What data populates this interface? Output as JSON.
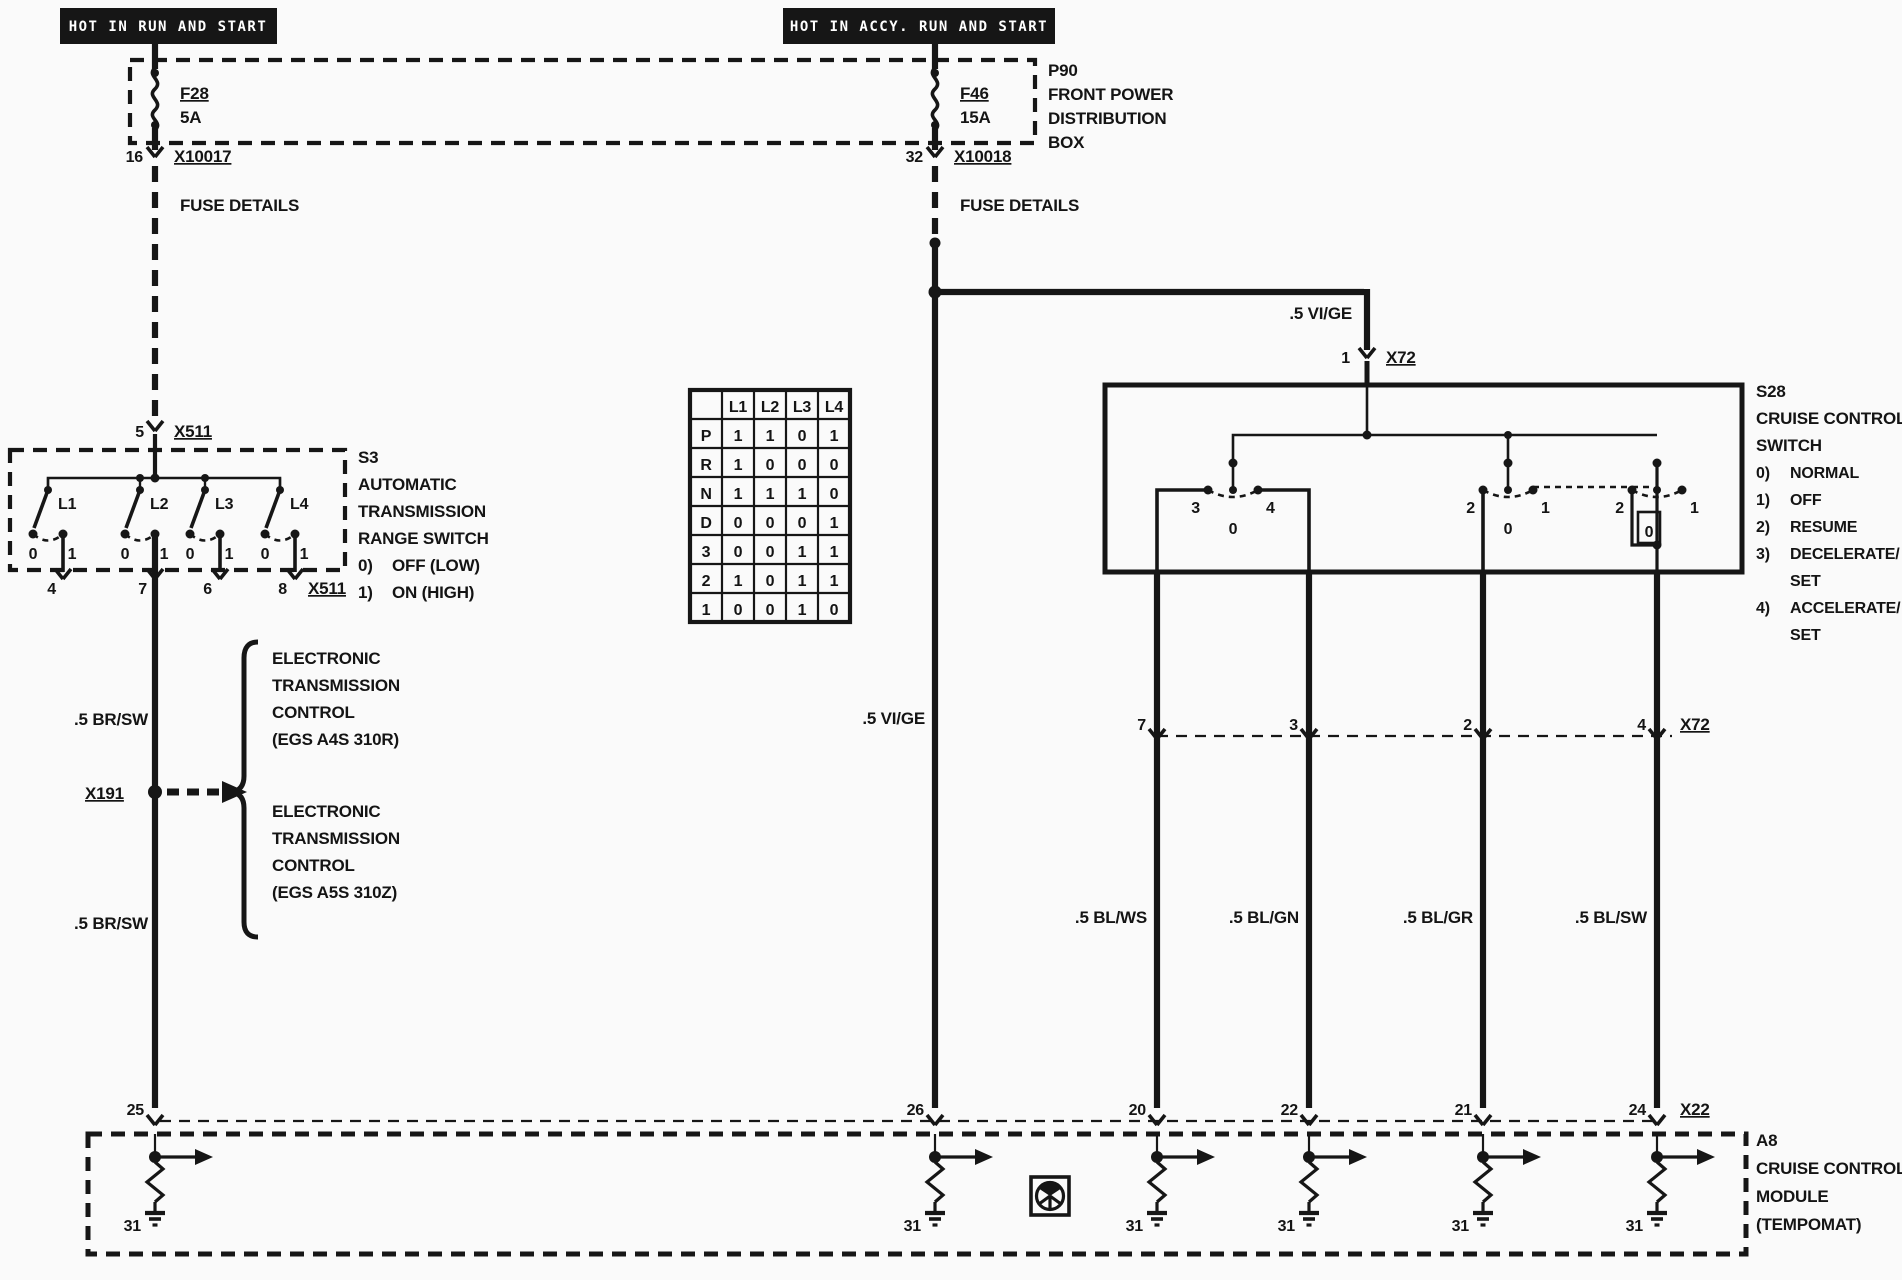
{
  "banners": {
    "left": "HOT IN RUN AND START",
    "right": "HOT IN ACCY. RUN AND START"
  },
  "p90": {
    "id": "P90",
    "name1": "FRONT POWER",
    "name2": "DISTRIBUTION",
    "name3": "BOX"
  },
  "f28": {
    "id": "F28",
    "rating": "5A",
    "pin": "16",
    "connector": "X10017",
    "note": "FUSE DETAILS"
  },
  "f46": {
    "id": "F46",
    "rating": "15A",
    "pin": "32",
    "connector": "X10018",
    "note": "FUSE DETAILS"
  },
  "s3": {
    "id": "S3",
    "name1": "AUTOMATIC",
    "name2": "TRANSMISSION",
    "name3": "RANGE SWITCH",
    "pos0key": "0)",
    "pos0": "OFF (LOW)",
    "pos1key": "1)",
    "pos1": "ON (HIGH)",
    "pin_top": "5",
    "connector_top": "X511",
    "gates": [
      "L1",
      "L2",
      "L3",
      "L4"
    ],
    "off": "0",
    "on": "1",
    "pins": [
      "4",
      "7",
      "6",
      "8"
    ],
    "connector_bottom": "X511"
  },
  "table": {
    "cols": [
      "L1",
      "L2",
      "L3",
      "L4"
    ],
    "rows": [
      [
        "P",
        "1",
        "1",
        "0",
        "1"
      ],
      [
        "R",
        "1",
        "0",
        "0",
        "0"
      ],
      [
        "N",
        "1",
        "1",
        "1",
        "0"
      ],
      [
        "D",
        "0",
        "0",
        "0",
        "1"
      ],
      [
        "3",
        "0",
        "0",
        "1",
        "1"
      ],
      [
        "2",
        "1",
        "0",
        "1",
        "1"
      ],
      [
        "1",
        "0",
        "0",
        "1",
        "0"
      ]
    ]
  },
  "left_wire": {
    "label_upper": ".5 BR/SW",
    "label_lower": ".5 BR/SW",
    "connector": "X191",
    "target1": [
      "ELECTRONIC",
      "TRANSMISSION",
      "CONTROL",
      "(EGS A4S 310R)"
    ],
    "target2": [
      "ELECTRONIC",
      "TRANSMISSION",
      "CONTROL",
      "(EGS A5S 310Z)"
    ]
  },
  "mid_wire": {
    "label": ".5 VI/GE",
    "label2": ".5 VI/GE",
    "pin": "1",
    "connector": "X72"
  },
  "s28": {
    "id": "S28",
    "name1": "CRUISE CONTROL",
    "name2": "SWITCH",
    "legend": [
      [
        "0)",
        "NORMAL"
      ],
      [
        "1)",
        "OFF"
      ],
      [
        "2)",
        "RESUME"
      ],
      [
        "3)",
        "DECELERATE/"
      ],
      [
        "",
        "SET"
      ],
      [
        "4)",
        "ACCELERATE/"
      ],
      [
        "",
        "SET"
      ]
    ],
    "sw1": {
      "l": "3",
      "c": "0",
      "r": "4"
    },
    "sw2": {
      "l": "2",
      "c": "0",
      "r": "1"
    },
    "sw3": {
      "l": "2",
      "c": "0",
      "r": "1"
    }
  },
  "x72_row": {
    "pins": [
      "7",
      "3",
      "2",
      "4"
    ],
    "connector": "X72"
  },
  "wire_labels": [
    ".5 BL/WS",
    ".5 BL/GN",
    ".5 BL/GR",
    ".5 BL/SW"
  ],
  "a8": {
    "id": "A8",
    "name1": "CRUISE CONTROL",
    "name2": "MODULE",
    "name3": "(TEMPOMAT)",
    "connector": "X22",
    "pins": [
      "25",
      "26",
      "20",
      "22",
      "21",
      "24"
    ],
    "ground": "31"
  }
}
